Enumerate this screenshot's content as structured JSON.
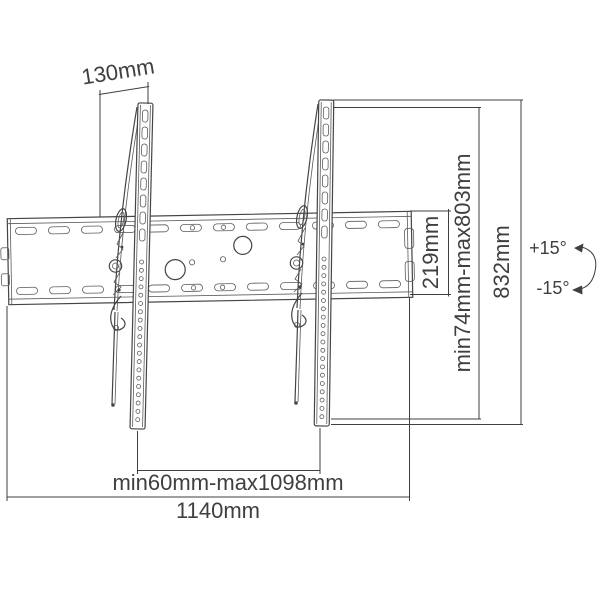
{
  "diagram": {
    "type": "technical-dimension-drawing",
    "subject": "tilting TV wall mount bracket",
    "background_color": "#ffffff",
    "line_color": "#3f3f3f",
    "dimensions": {
      "rail_top_offset": "130mm",
      "plate_height": "219mm",
      "vertical_adjust_range": "min74mm-max803mm",
      "total_height": "832mm",
      "tilt_up": "+15°",
      "tilt_down": "-15°",
      "rail_spacing_range": "min60mm-max1098mm",
      "total_width": "1140mm"
    }
  }
}
